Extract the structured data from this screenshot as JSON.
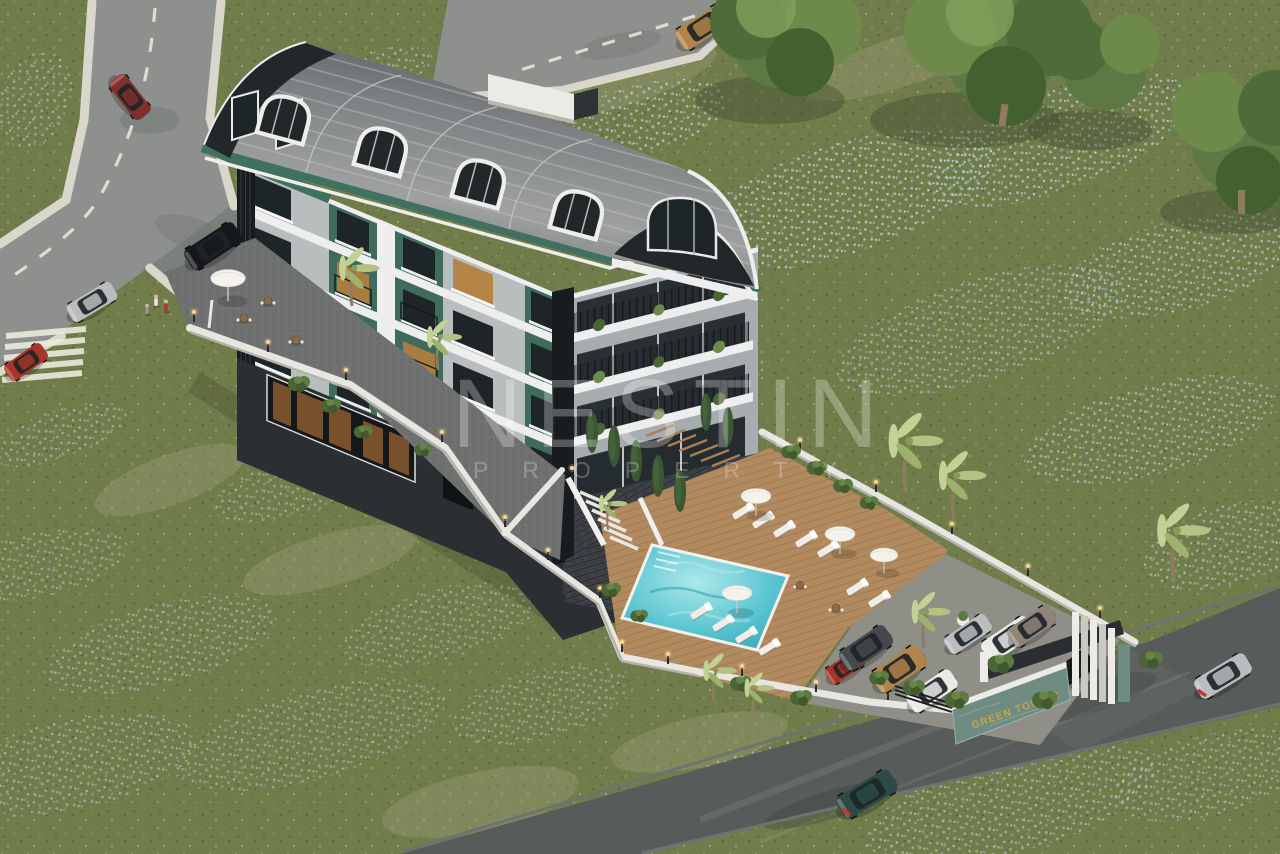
{
  "watermark": {
    "line1": "NESTIN",
    "line2": "PROPERTY"
  },
  "entrance_sign": {
    "text": "GREEN TOWN 2"
  },
  "scene": {
    "type": "aerial 3D architectural rendering",
    "subject": "five-storey residential building with curved metal roof on a flower meadow, pool terrace and gated parking",
    "building": {
      "roof": "curved barrel metal roof with arched dormer windows",
      "facade": "grey and white horizontal bands with dark green accent panels and black louver fins",
      "ground_floor": "glass storefront with cafe terrace and parasol"
    },
    "amenities": [
      "swimming pool",
      "timber sun deck",
      "sun loungers",
      "white parasols",
      "stairs to pool level",
      "perimeter walls with bollard lights",
      "gated entrance",
      "car parking",
      "palm trees",
      "cypress trees",
      "flower meadow"
    ],
    "roads": [
      "road with zebra crossing upper left",
      "road along top edge",
      "access road lower right"
    ],
    "vehicles": [
      {
        "type": "jeep",
        "color": "sand",
        "location": "top road"
      },
      {
        "type": "car",
        "color": "dark red",
        "location": "upper-left road"
      },
      {
        "type": "SUV",
        "color": "black",
        "location": "parked at building"
      },
      {
        "type": "sports car",
        "color": "silver",
        "location": "upper-left road"
      },
      {
        "type": "hatchback",
        "color": "red",
        "location": "left road at crossing"
      },
      {
        "type": "mini",
        "color": "red",
        "location": "parking"
      },
      {
        "type": "SUV",
        "color": "charcoal",
        "location": "parking"
      },
      {
        "type": "jeep",
        "color": "sand",
        "location": "parking"
      },
      {
        "type": "sedan",
        "color": "white",
        "location": "parking"
      },
      {
        "type": "SUV",
        "color": "white",
        "location": "parking"
      },
      {
        "type": "SUV",
        "color": "taupe",
        "location": "parking"
      },
      {
        "type": "SUV",
        "color": "black",
        "location": "inside gate"
      },
      {
        "type": "SUV",
        "color": "dark teal",
        "location": "lower road"
      },
      {
        "type": "sedan",
        "color": "silver",
        "location": "lower road"
      }
    ]
  },
  "palette": {
    "grass": "#717c4b",
    "grassDark": "#5e6b3c",
    "grassLight": "#8d9a62",
    "dry": "#a9a886",
    "flowerA": "#a9c4d2",
    "flowerB": "#d8e4e7",
    "flowerC": "#8fb2c2",
    "roadLight": "#8d908d",
    "roadMid": "#7c807c",
    "roadDark": "#575b59",
    "sidewalk": "#d9d6cb",
    "marking": "#eceade",
    "roofLo": "#55585a",
    "roofHi": "#9b9d9d",
    "roofRib": "#c2c4c4",
    "roofTrim": "#eeeeec",
    "gableFace": "#23272a",
    "fascia": "#40705f",
    "fasciaHi": "#5d9480",
    "facade": "#b8bdbd",
    "facadeSide": "#a7acae",
    "band": "#edeeed",
    "accent": "#3e6b5b",
    "win": "#1e2528",
    "winLit": "#b5803c",
    "frame": "#e9e9e6",
    "louver": "#191c1e",
    "base": "#2b2f32",
    "stone": "#3e4246",
    "wall": "#e8e6e1",
    "wallShade": "#b5b3ac",
    "pool": "#54c2ce",
    "poolLight": "#ace8ea",
    "poolDark": "#2e9dac",
    "deck": "#b28a60",
    "deckLine": "#94704b",
    "lounger": "#f0ede7",
    "umbrella": "#f4f2eb",
    "pavement": "#8f8f88",
    "cobble": "#6e7170",
    "driveway": "#5e6260",
    "beam": "#2b2e30",
    "fin": "#c9c8c2",
    "gateWhite": "#edebe7",
    "marble": "#6e8c81",
    "marbleLight": "#9cb2a8",
    "signText": "#c9a24b",
    "bush": "#4a6635",
    "bushLight": "#6d8a4a",
    "canopy": "#5d7842",
    "canopyDark": "#44602e",
    "canopyLight": "#7fa05a",
    "cypress": "#3a5632",
    "frond": "#c4d194",
    "frond2": "#9cb26d",
    "trunk": "#8d7c5f",
    "carBlack": "#16181b",
    "carSilver": "#babcbe",
    "carRed": "#a83527",
    "carMaroon": "#802f2b",
    "carTan": "#b28449",
    "carCharcoal": "#45494c",
    "carWhite": "#eaeae8",
    "carTaupe": "#90847a",
    "carTeal": "#2c4b47",
    "tire": "#0f1113",
    "glass": "#1d2427",
    "skin": "#d9b897",
    "lampGlow": "#ffd791",
    "lampPost": "#2a2a28"
  }
}
